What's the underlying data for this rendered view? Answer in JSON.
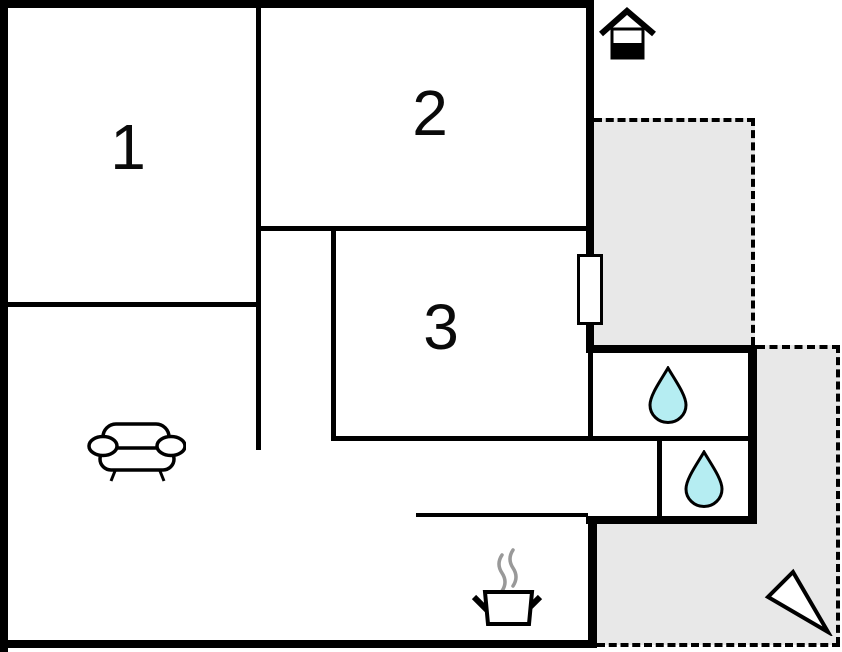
{
  "plan": {
    "rooms": [
      {
        "id": "room-1",
        "label": "1"
      },
      {
        "id": "room-2",
        "label": "2"
      },
      {
        "id": "room-3",
        "label": "3"
      }
    ],
    "icons": {
      "entrance": "house-icon",
      "living_room": "sofa-icon",
      "kitchen": "cooking-pot-icon",
      "bathroom_1": "water-drop-icon",
      "bathroom_2": "water-drop-icon",
      "orientation": "north-arrow-icon",
      "opening": "door-window-marker"
    },
    "colors": {
      "wall": "#000000",
      "terrace_fill": "#e8e8e8",
      "water_drop_fill": "#b5edf2",
      "steam": "#999999",
      "icon_fill": "#ffffff",
      "background": "#ffffff"
    }
  }
}
